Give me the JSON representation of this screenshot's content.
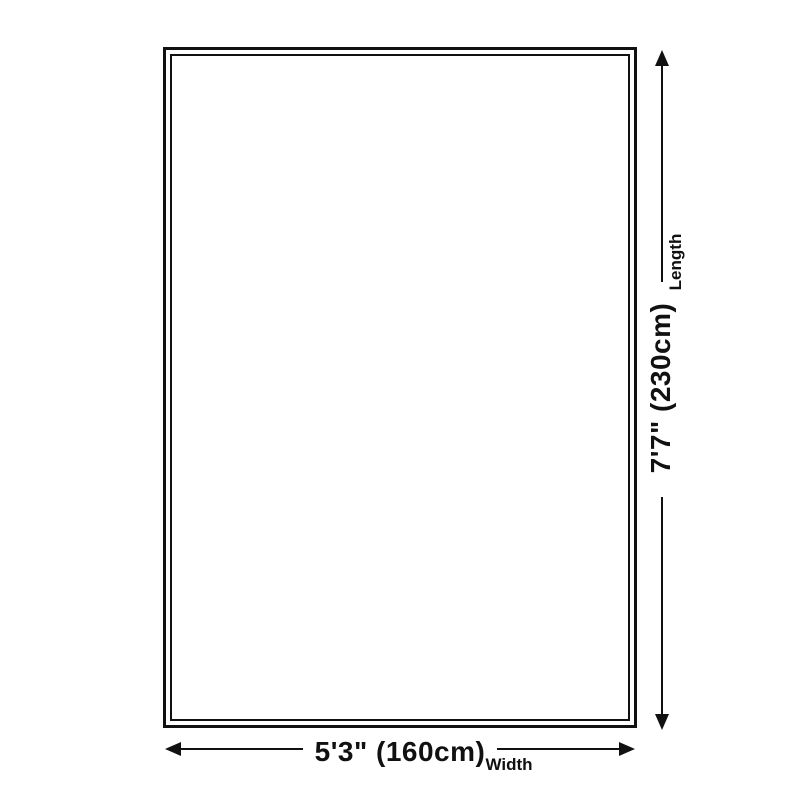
{
  "diagram": {
    "type": "product-dimension-diagram",
    "length": {
      "label": "Length",
      "value": "7'7\" (230cm)"
    },
    "width": {
      "label": "Width",
      "value": "5'3\" (160cm)"
    }
  },
  "colors": {
    "line": "#111111",
    "text": "#111111",
    "background": "#ffffff"
  }
}
